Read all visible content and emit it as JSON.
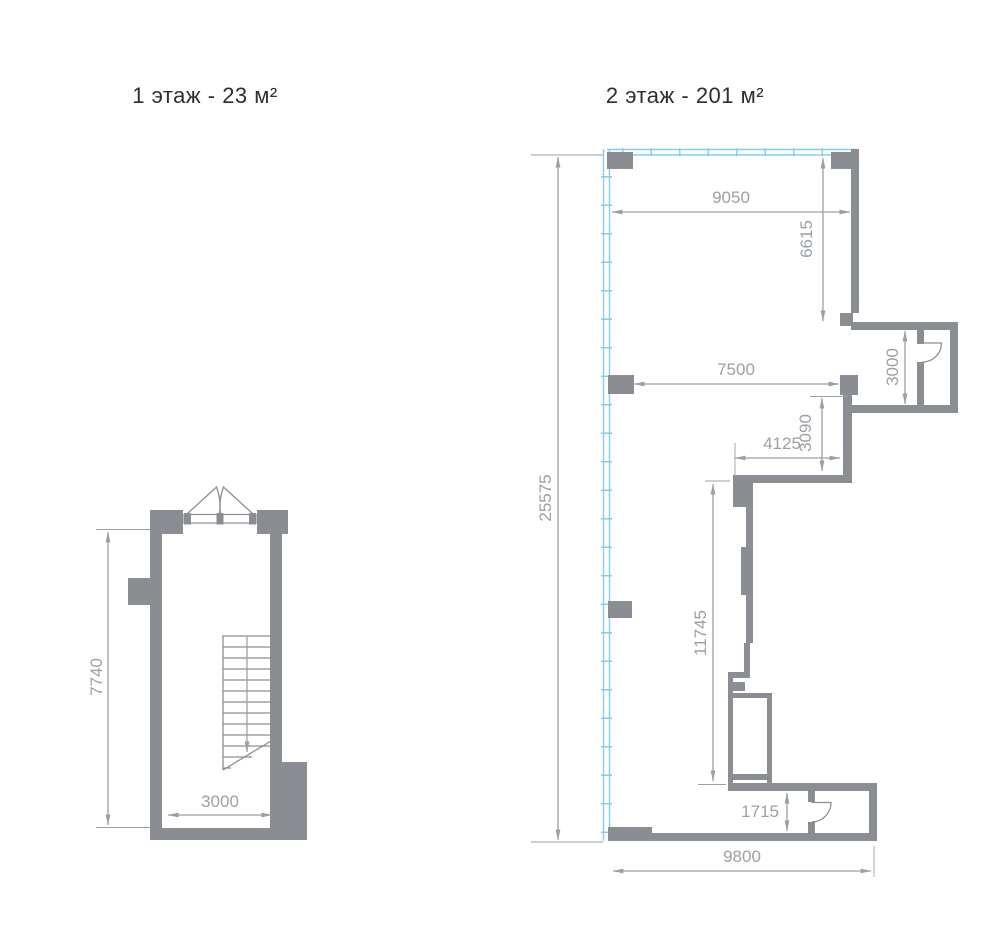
{
  "colors": {
    "wall": "#8a8e93",
    "dimension": "#9aa0a5",
    "glazing": "#85cdec",
    "title_text": "#2e2e2e",
    "background": "#ffffff"
  },
  "floor1": {
    "title": "1 этаж - 23 м²",
    "dimensions": {
      "interior_height": "7740",
      "interior_width": "3000"
    }
  },
  "floor2": {
    "title": "2 этаж - 201 м²",
    "dimensions": {
      "overall_height": "25575",
      "overall_width": "9800",
      "top_width": "9050",
      "right_depth": "6615",
      "mid_width": "7500",
      "side_room_depth": "3000",
      "step_depth": "3090",
      "step_width": "4125",
      "inner_wall_length": "11745",
      "entry_depth": "1715"
    }
  }
}
